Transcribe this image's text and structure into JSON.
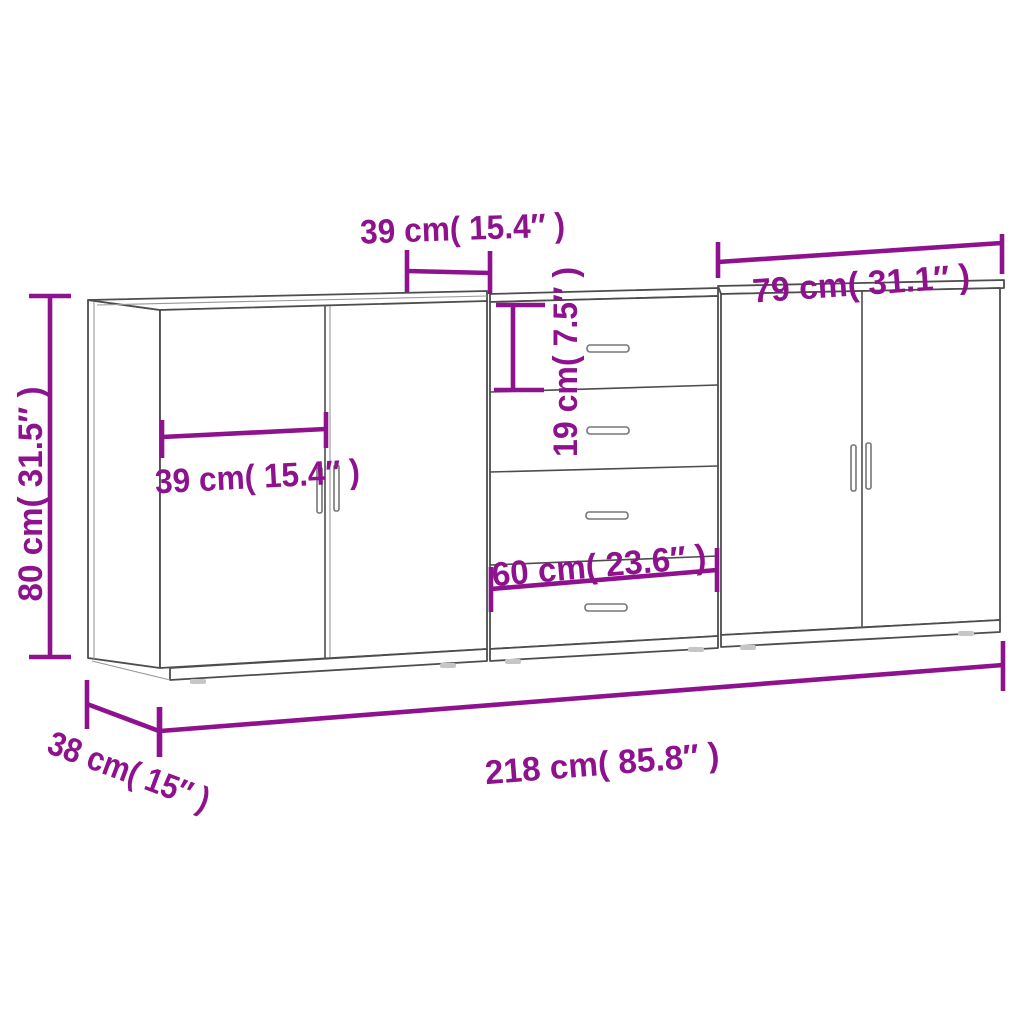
{
  "diagram": {
    "title": "Sideboard 3-unit dimensions diagram",
    "units": "cm / inches",
    "colors": {
      "dimension_accent": "#8E128E",
      "furniture_outline": "#4d4d4d",
      "background": "#ffffff"
    },
    "labels": {
      "door_width_top": "39 cm( 15.4″ )",
      "right_unit_width": "79 cm( 31.1″ )",
      "height": "80 cm( 31.5″ )",
      "left_door_width": "39 cm( 15.4″ )",
      "drawer_height": "19 cm( 7.5″ )",
      "middle_unit_width": "60 cm( 23.6″ )",
      "total_width": "218 cm( 85.8″ )",
      "depth": "38 cm( 15″ )"
    }
  }
}
